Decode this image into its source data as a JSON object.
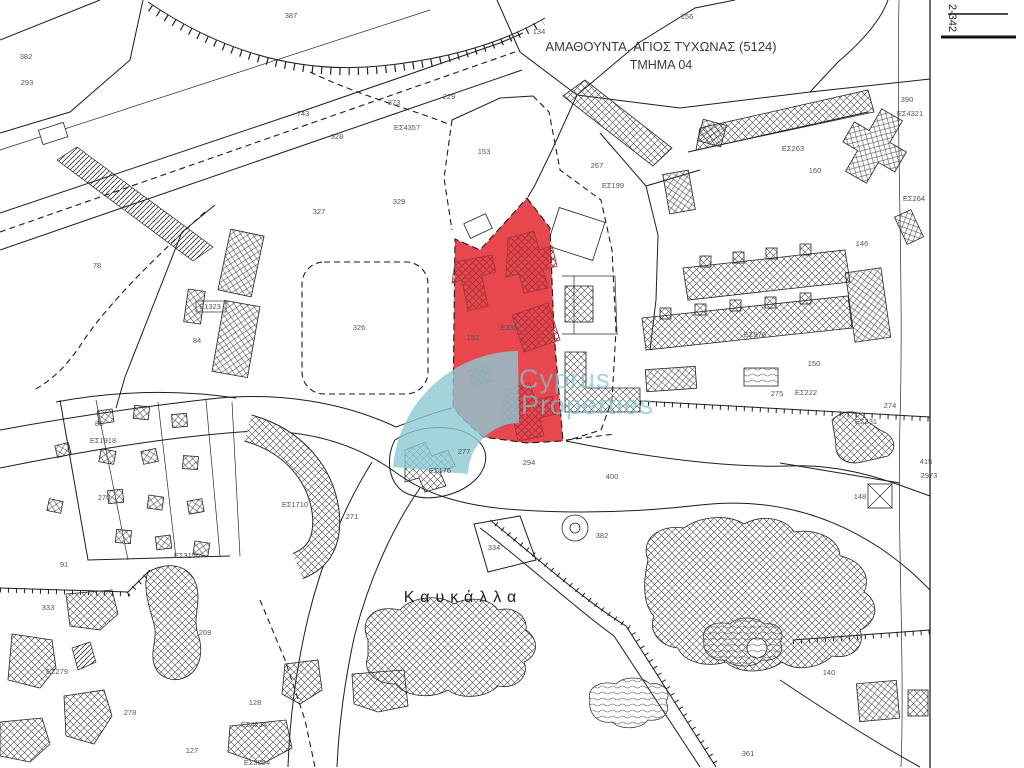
{
  "map": {
    "title_line1": "ΑΜΑΘΟΥΝΤΑ, ΑΓΙΟΣ ΤΥΧΩΝΑΣ (5124)",
    "title_line2": "ΤΜΗΜΑ 04",
    "place_name": "Καυκάλλα",
    "sheet_ref": "2-342",
    "highlight_color": "#e8474e",
    "watermark": {
      "line1": "Cyprus",
      "line2": "Properties",
      "color": "#8cc8d2"
    },
    "labels": [
      {
        "text": "387",
        "x": 291,
        "y": 18
      },
      {
        "text": "134",
        "x": 539,
        "y": 34
      },
      {
        "text": "156",
        "x": 687,
        "y": 19
      },
      {
        "text": "382",
        "x": 26,
        "y": 59
      },
      {
        "text": "293",
        "x": 27,
        "y": 85
      },
      {
        "text": "743",
        "x": 303,
        "y": 116
      },
      {
        "text": "373",
        "x": 394,
        "y": 105
      },
      {
        "text": "229",
        "x": 449,
        "y": 99
      },
      {
        "text": "ΕΣ4357",
        "x": 407,
        "y": 130
      },
      {
        "text": "328",
        "x": 337,
        "y": 139
      },
      {
        "text": "153",
        "x": 484,
        "y": 154
      },
      {
        "text": "327",
        "x": 319,
        "y": 214
      },
      {
        "text": "329",
        "x": 399,
        "y": 204
      },
      {
        "text": "267",
        "x": 597,
        "y": 168
      },
      {
        "text": "ΕΣ199",
        "x": 613,
        "y": 188
      },
      {
        "text": "ΕΣ263",
        "x": 793,
        "y": 151
      },
      {
        "text": "160",
        "x": 815,
        "y": 173
      },
      {
        "text": "390",
        "x": 907,
        "y": 102
      },
      {
        "text": "ΕΣ4321",
        "x": 910,
        "y": 116
      },
      {
        "text": "ΕΣ264",
        "x": 914,
        "y": 201
      },
      {
        "text": "78",
        "x": 97,
        "y": 268
      },
      {
        "text": "Ε1323",
        "x": 210,
        "y": 309
      },
      {
        "text": "84",
        "x": 197,
        "y": 343
      },
      {
        "text": "326",
        "x": 359,
        "y": 330
      },
      {
        "text": "152",
        "x": 473,
        "y": 340,
        "color": "#8d3a42"
      },
      {
        "text": "Ε335",
        "x": 509,
        "y": 330,
        "color": "#8d3a42"
      },
      {
        "text": "146",
        "x": 862,
        "y": 246
      },
      {
        "text": "ΕΣ976",
        "x": 755,
        "y": 337
      },
      {
        "text": "150",
        "x": 814,
        "y": 366
      },
      {
        "text": "275",
        "x": 777,
        "y": 396
      },
      {
        "text": "ΕΣ222",
        "x": 806,
        "y": 395
      },
      {
        "text": "274",
        "x": 890,
        "y": 408
      },
      {
        "text": "ΕΣ231",
        "x": 866,
        "y": 424
      },
      {
        "text": "148",
        "x": 860,
        "y": 499
      },
      {
        "text": "86",
        "x": 99,
        "y": 426
      },
      {
        "text": "ΕΣ1918",
        "x": 103,
        "y": 443
      },
      {
        "text": "270",
        "x": 104,
        "y": 500
      },
      {
        "text": "ΕΣ3156",
        "x": 187,
        "y": 558
      },
      {
        "text": "91",
        "x": 64,
        "y": 567
      },
      {
        "text": "333",
        "x": 48,
        "y": 610
      },
      {
        "text": "ΕΣ279",
        "x": 57,
        "y": 674
      },
      {
        "text": "278",
        "x": 130,
        "y": 715
      },
      {
        "text": "127",
        "x": 192,
        "y": 753
      },
      {
        "text": "128",
        "x": 255,
        "y": 705
      },
      {
        "text": "ΕΣ4234",
        "x": 254,
        "y": 727
      },
      {
        "text": "ΕΣ3094",
        "x": 257,
        "y": 765
      },
      {
        "text": "ΕΣ1710",
        "x": 295,
        "y": 507
      },
      {
        "text": "271",
        "x": 352,
        "y": 519
      },
      {
        "text": "269",
        "x": 205,
        "y": 635
      },
      {
        "text": "277",
        "x": 464,
        "y": 454
      },
      {
        "text": "ΕΣ176",
        "x": 440,
        "y": 473
      },
      {
        "text": "294",
        "x": 529,
        "y": 465
      },
      {
        "text": "400",
        "x": 612,
        "y": 479
      },
      {
        "text": "334",
        "x": 494,
        "y": 550
      },
      {
        "text": "382",
        "x": 602,
        "y": 538
      },
      {
        "text": "140",
        "x": 829,
        "y": 675
      },
      {
        "text": "361",
        "x": 748,
        "y": 756
      },
      {
        "text": "415",
        "x": 926,
        "y": 464,
        "color": "#9a9a9a"
      },
      {
        "text": "2973",
        "x": 929,
        "y": 478,
        "color": "#9a9a9a"
      }
    ]
  }
}
